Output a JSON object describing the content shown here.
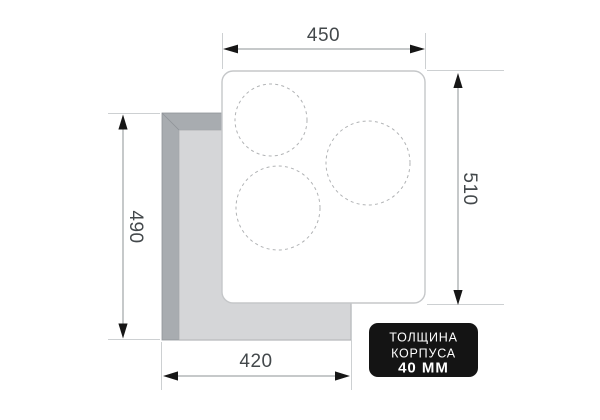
{
  "diagram": {
    "dimensions": {
      "top": {
        "label": "450"
      },
      "right": {
        "label": "510"
      },
      "left": {
        "label": "490"
      },
      "bottom": {
        "label": "420"
      }
    },
    "badge": {
      "line1": "ТОЛЩИНА",
      "line2": "КОРПУСА",
      "line3": "40 ММ"
    },
    "burners": [
      {
        "cx": "271",
        "cy": "120",
        "r": "36"
      },
      {
        "cx": "368",
        "cy": "163",
        "r": "42"
      },
      {
        "cx": "278",
        "cy": "208",
        "r": "42"
      }
    ],
    "colors": {
      "badge_bg": "#141414",
      "badge_text": "#ffffff",
      "cutout_bevel_dark": "#a8acb0",
      "cutout_face_light": "#d5d6d8",
      "cutout_outline": "#8f9499",
      "panel_fill": "#ffffff",
      "panel_border": "#c5c7c9",
      "dimension_text": "#43484b",
      "arrowhead": "#161616",
      "dimension_line": "#8e9396",
      "extension_line": "#cdd0d2"
    }
  }
}
